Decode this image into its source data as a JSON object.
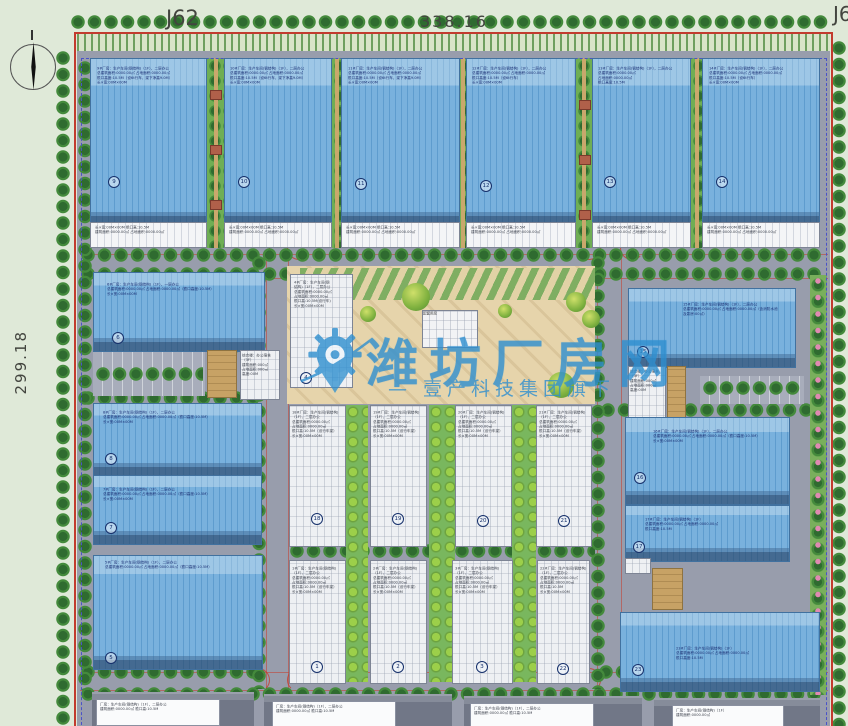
{
  "labels": {
    "top_left_point": "J62",
    "top_dimension": "338.16",
    "left_dimension": "299.18",
    "top_right_point": "J6"
  },
  "watermark": {
    "brand": "潍坊厂房网",
    "subtitle": "— 壹产科技集团旗下",
    "color": "#2e8fd0"
  },
  "plaza": {
    "center_building_label": "配套用房"
  },
  "common": {
    "table_text": "长×宽:00M×00M  檐口高:10.5M\n建筑面积:0000.00㎡  占地面积:0000.00㎡"
  },
  "buildings": {
    "t1": {
      "number": "9",
      "ann": "9#厂房：生产车间(钢结构)（1F），二层办公\n总建筑面积:0000.00㎡  占地面积:0000.00㎡\n檐口高度:10.5M（设6t行车，梁下净高9.0M）\n长×宽:00M×00M"
    },
    "t2": {
      "number": "10",
      "ann": "10#厂房：生产车间(钢结构)（1F），二层办公\n总建筑面积:0000.00㎡  占地面积:0000.00㎡\n檐口高度:10.5M（设6t行车，梁下净高9.0M）\n长×宽:00M×00M"
    },
    "t3": {
      "number": "11",
      "ann": "11#厂房：生产车间(钢结构)（1F），二层办公\n总建筑面积:0000.00㎡  占地面积:0000.00㎡\n檐口高度:10.5M（设6t行车，梁下净高9.0M）\n长×宽:00M×00M"
    },
    "t4": {
      "number": "12",
      "ann": "12#厂房：生产车间(钢结构)（1F），二层办公\n总建筑面积:0000.00㎡  占地面积:0000.00㎡\n檐口高度:10.5M（设6t行车）\n长×宽:00M×00M"
    },
    "t5": {
      "number": "13",
      "ann": "13#厂房：生产车间(钢结构)（1F），二层办公\n总建筑面积:0000.00㎡\n占地面积:0000.00㎡\n檐口高度:10.5M"
    },
    "t6": {
      "number": "14",
      "ann": "14#厂房：生产车间(钢结构)（1F），二层办公\n总建筑面积:0000.00㎡  占地面积:0000.00㎡\n檐口高度:10.5M（设6t行车）\n长×宽:00M×00M"
    },
    "r2l": {
      "number": "6",
      "ann": "6#厂房：生产车间(钢结构)（1F），一层办公\n总建筑面积:0000.00㎡  占地面积:0000.00㎡（檐口高度:10.5M）\n长×宽:00M×00M"
    },
    "r2c": {
      "number": "4",
      "ann": "4#厂房：生产车间(钢\n结构)（1F），二层办公\n总建筑面积:0000.00㎡\n占地面积:0000.00㎡\n檐口高:10.5M(设行车)\n长×宽:00M×00M"
    },
    "r2r": {
      "number": "15",
      "ann": "15#厂房：生产车间(钢结构)（1F），二层办公\n总建筑面积:0000.00㎡  占地面积:0000.00㎡（含消防水池\n及泵房:00㎡）"
    },
    "r2rw": {
      "ann": "综合楼：办公宿舍\n（3F）\n建筑面积:000㎡\n占地面积:000㎡\n高度:00M"
    },
    "r2lw": {
      "ann": "综合楼：办公宿舍\n（3F）\n建筑面积:000㎡\n占地面积:000㎡\n高度:00M"
    },
    "r3la": {
      "number": "8",
      "ann": "8#厂房：生产车间(钢结构)（1F），二层办公\n总建筑面积:0000.00㎡  占地面积:0000.00㎡（檐口高度:10.5M）\n长×宽:00M×00M"
    },
    "r3lb": {
      "number": "7",
      "ann": "7#厂房：生产车间(钢结构)（1F），二层办公\n总建筑面积:0000.00㎡  占地面积:0000.00㎡（檐口高度:10.5M）\n长×宽:00M×00M"
    },
    "r3w1": {
      "number": "18",
      "ann": "18#厂房：生产车间(钢结构)\n（1F），二层办公\n总建筑面积:0000.00㎡\n占地面积:0000.00㎡\n檐口高:10.5M（设行车梁）\n长×宽:00M×00M"
    },
    "r3w2": {
      "number": "19",
      "ann": "19#厂房：生产车间(钢结构)\n（1F），二层办公\n总建筑面积:0000.00㎡\n占地面积:0000.00㎡\n檐口高:10.5M（设行车梁）\n长×宽:00M×00M"
    },
    "r3w3": {
      "number": "20",
      "ann": "20#厂房：生产车间(钢结构)\n（1F），二层办公\n总建筑面积:0000.00㎡\n占地面积:0000.00㎡\n檐口高:10.5M（设行车梁）\n长×宽:00M×00M"
    },
    "r3w4": {
      "number": "21",
      "ann": "21#厂房：生产车间(钢结构)\n（1F），二层办公\n总建筑面积:0000.00㎡\n占地面积:0000.00㎡\n檐口高:10.5M（设行车梁）\n长×宽:00M×00M"
    },
    "r3ra": {
      "number": "16",
      "ann": "16#厂房：生产车间(钢结构)（1F），二层办公\n总建筑面积:0000.00㎡  占地面积:0000.00㎡（檐口高度:10.5M）\n长×宽:00M×00M"
    },
    "r3rb": {
      "number": "17",
      "ann": "17#厂房：生产车间(钢结构)（1F）\n总建筑面积:0000.00㎡  占地面积:0000.00㎡\n檐口高度:10.5M"
    },
    "r4l": {
      "number": "5",
      "ann": "5#厂房：生产车间(钢结构)（1F），二层办公\n总建筑面积:0000.00㎡  占地面积:0000.00㎡（檐口高度:10.5M）"
    },
    "r4w1": {
      "number": "1",
      "ann": "1#厂房：生产车间(钢结构)\n（1F），二层办公\n总建筑面积:0000.00㎡\n占地面积:0000.00㎡\n檐口高:10.5M（设行车梁）\n长×宽:00M×00M"
    },
    "r4w2": {
      "number": "2",
      "ann": "2#厂房：生产车间(钢结构)\n（1F），二层办公\n总建筑面积:0000.00㎡\n占地面积:0000.00㎡\n檐口高:10.5M（设行车梁）\n长×宽:00M×00M"
    },
    "r4w3": {
      "number": "3",
      "ann": "3#厂房：生产车间(钢结构)\n（1F），二层办公\n总建筑面积:0000.00㎡\n占地面积:0000.00㎡\n檐口高:10.5M（设行车梁）\n长×宽:00M×00M"
    },
    "r4w4": {
      "number": "22",
      "ann": "22#厂房：生产车间(钢结构)\n（1F），二层办公\n总建筑面积:0000.00㎡\n占地面积:0000.00㎡\n檐口高:10.5M\n长×宽:00M×00M"
    },
    "r4r": {
      "number": "23",
      "ann": "23#厂房：生产车间(钢结构)（1F）\n总建筑面积:0000.00㎡  占地面积:0000.00㎡\n檐口高度:10.5M"
    },
    "r4rt": {},
    "r2lt": {},
    "r2rt": {},
    "r3rbox": {}
  },
  "bottom_boxes": [
    {
      "text": "厂房：生产车间(钢结构)（1F），二层办公\n建筑面积:0000.00㎡  檐口高:10.5M"
    },
    {
      "text": "厂房：生产车间(钢结构)（1F），二层办公\n建筑面积:0000.00㎡  檐口高:10.5M"
    },
    {
      "text": "厂房：生产车间(钢结构)（1F），二层办公\n建筑面积:0000.00㎡  檐口高:10.5M"
    },
    {
      "text": "厂房：生产车间(钢结构)（1F）\n建筑面积:0000.00㎡"
    }
  ]
}
